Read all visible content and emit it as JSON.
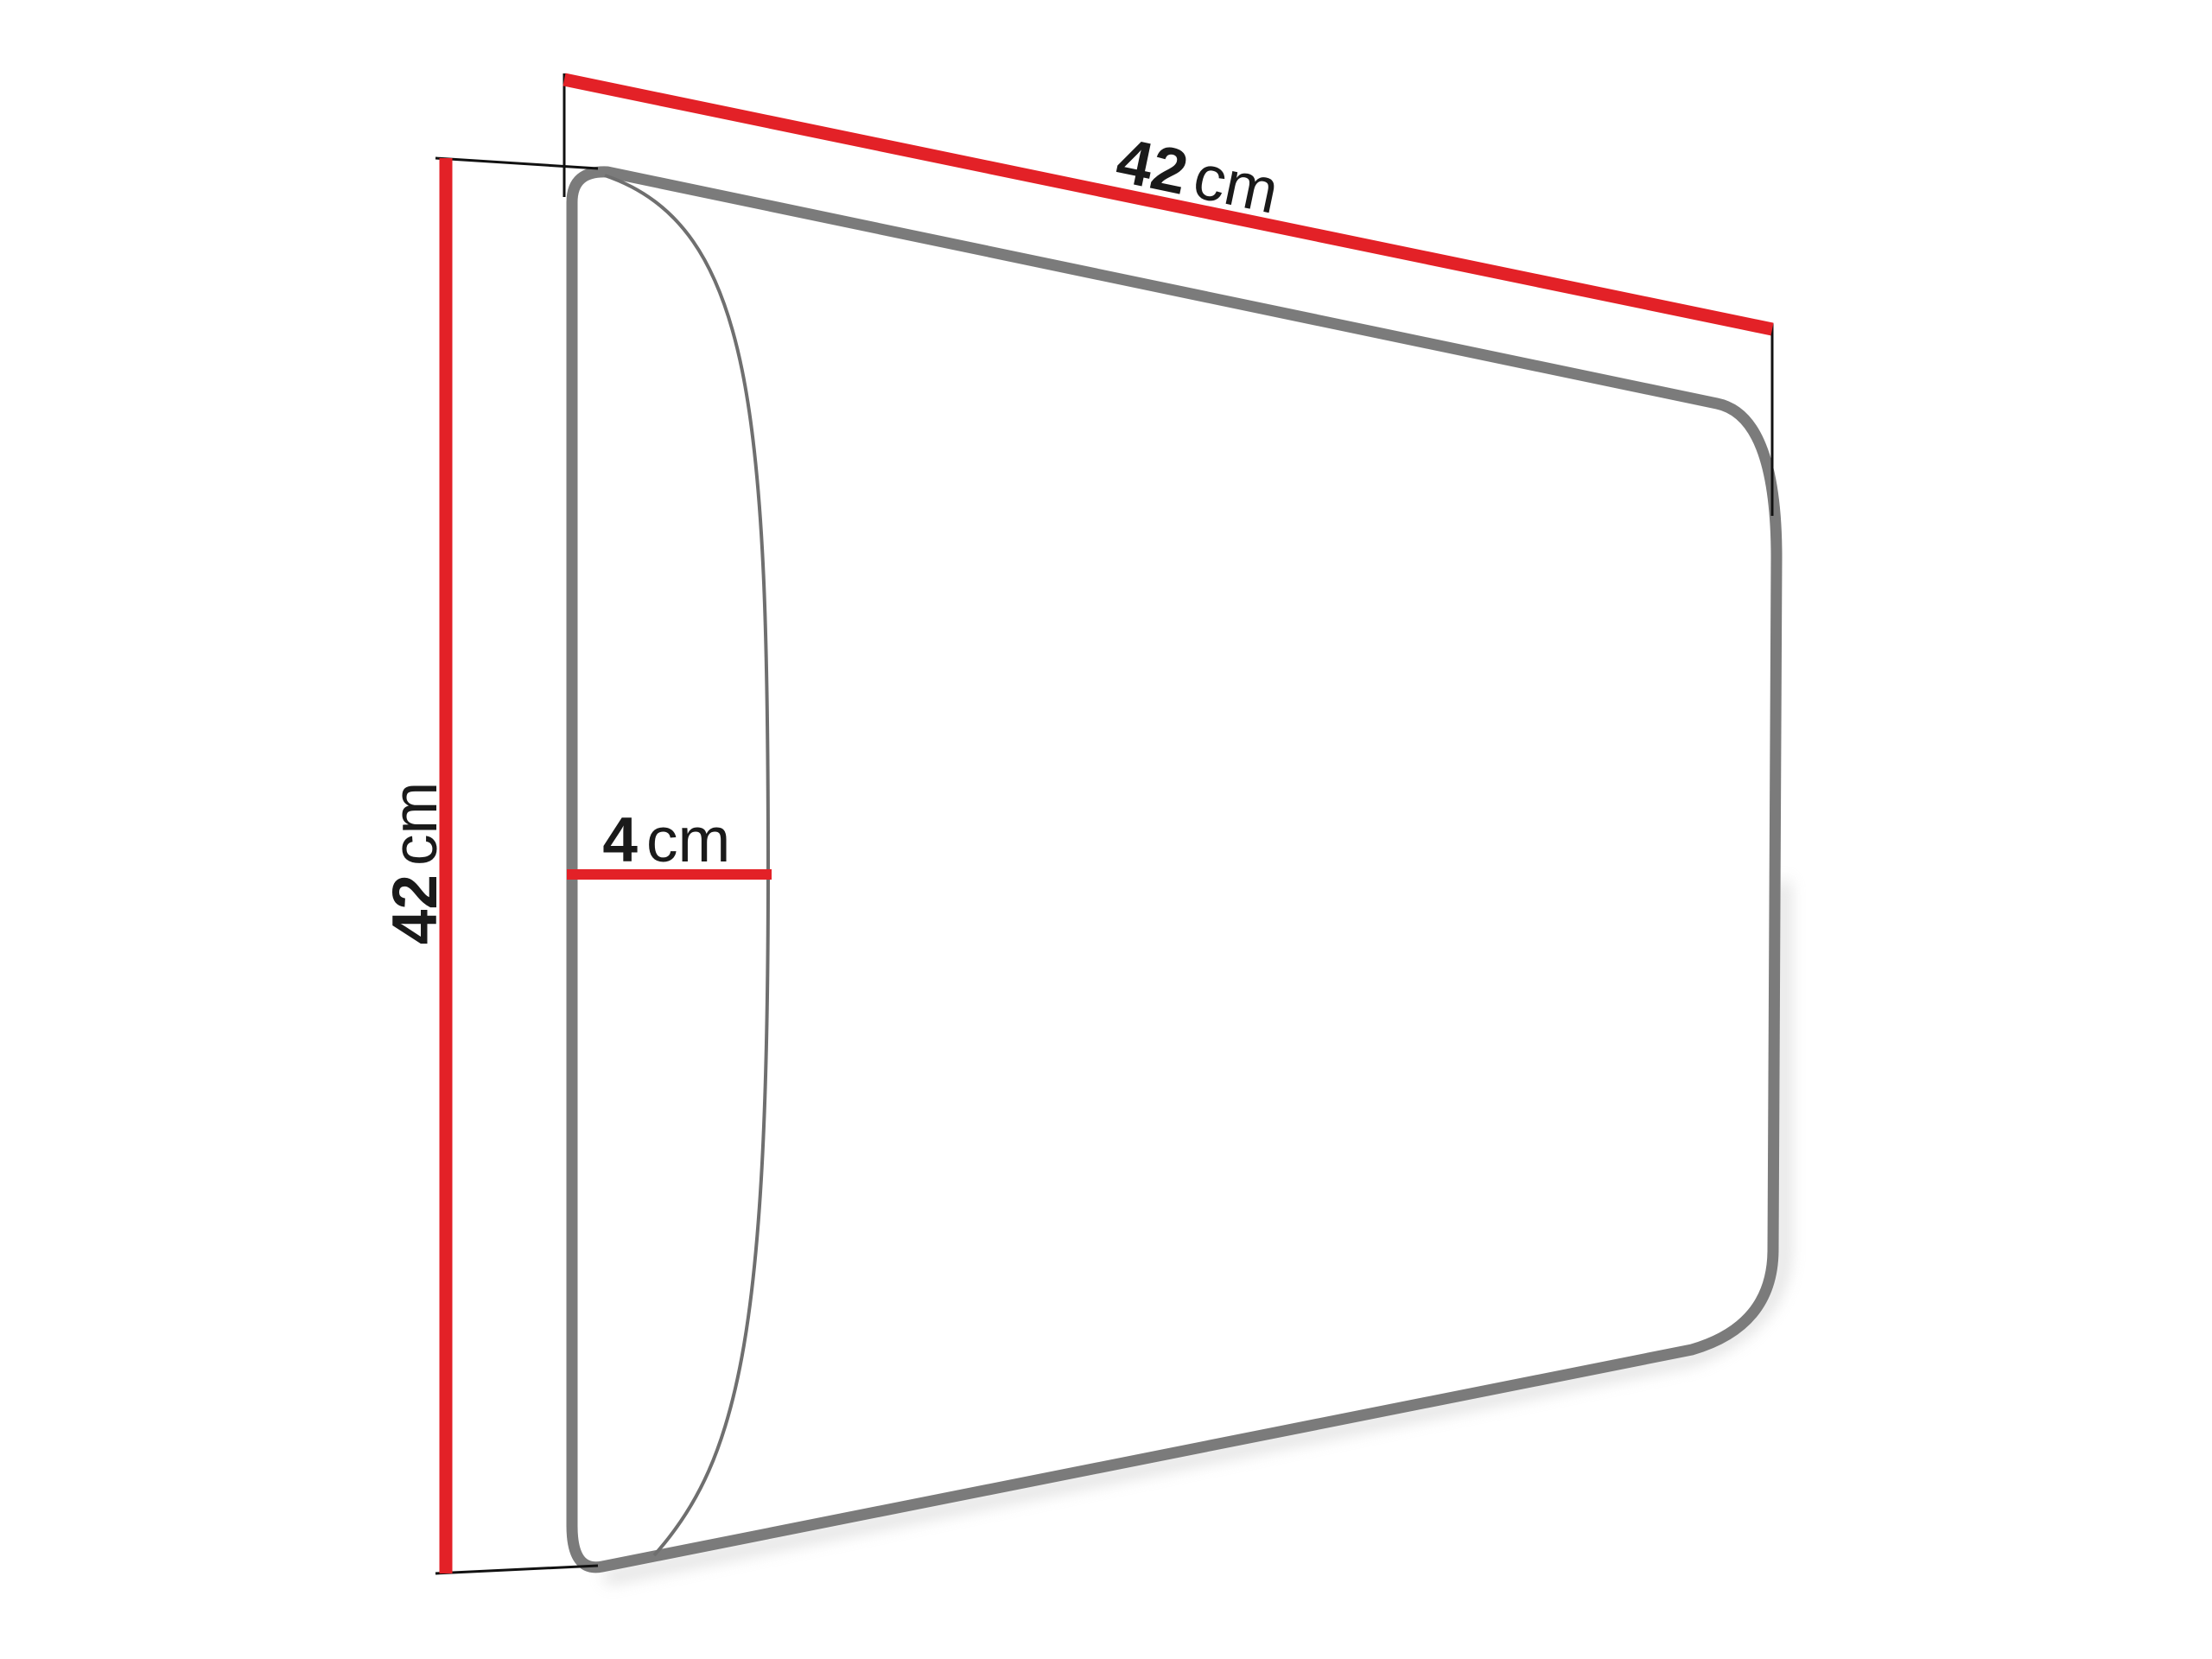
{
  "diagram": {
    "type": "dimension-drawing",
    "subject": "upholstered-wall-panel-side-perspective",
    "colors": {
      "background": "#ffffff",
      "dimension_line": "#e32127",
      "panel_outline": "#7b7b7b",
      "bulge_curve": "#6f6f6f",
      "extension_line": "#111111",
      "label_text": "#1a1a1a",
      "shadow": "#b3b3b3"
    },
    "labels": {
      "width": {
        "value": "42",
        "unit": "cm"
      },
      "height": {
        "value": "42",
        "unit": "cm"
      },
      "depth": {
        "value": "4",
        "unit": "cm"
      }
    }
  }
}
